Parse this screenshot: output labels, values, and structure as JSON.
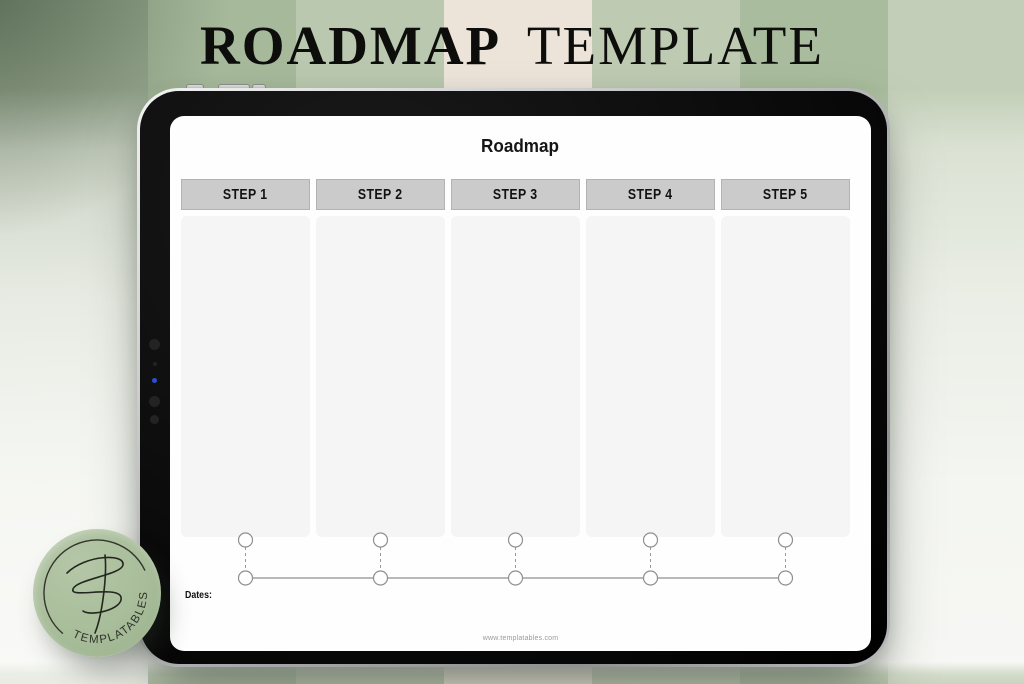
{
  "header": {
    "title_primary": "ROADMAP",
    "title_secondary": "TEMPLATE"
  },
  "tablet": {
    "sheet_title": "Roadmap",
    "steps": [
      {
        "label": "STEP 1"
      },
      {
        "label": "STEP 2"
      },
      {
        "label": "STEP 3"
      },
      {
        "label": "STEP 4"
      },
      {
        "label": "STEP 5"
      }
    ],
    "dates_label": "Dates:",
    "footer_url": "www.templatables.com"
  },
  "logo_badge": {
    "brand": "TEMPLATABLES",
    "monogram": "TF"
  },
  "colors": {
    "stripe_sage": "#a6b99b",
    "stripe_light_green": "#b9c8af",
    "stripe_cream": "#ece4d9",
    "stripe_gray_green": "#bfcab3",
    "badge_green": "#a8bd9a",
    "step_header_gray": "#cbcbcb",
    "step_column_gray": "#f5f5f5",
    "tablet_black": "#0a0a0a",
    "timeline_stroke": "#8f8f8f"
  }
}
